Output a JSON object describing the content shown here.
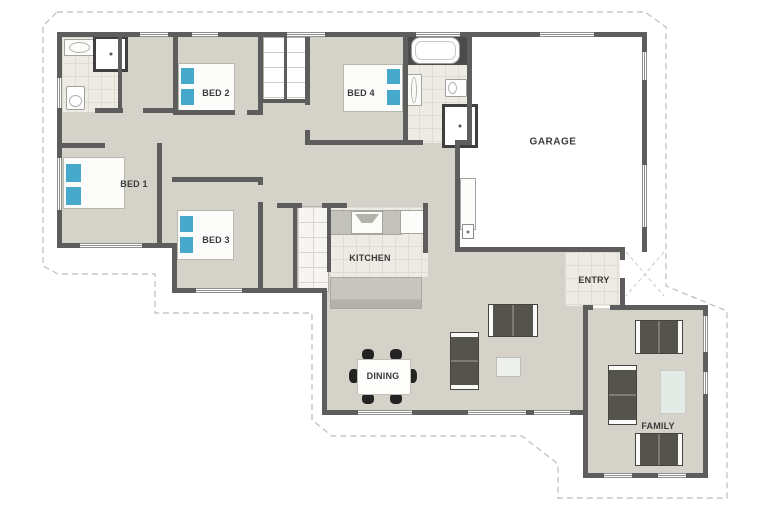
{
  "plan": {
    "rooms": {
      "garage": "GARAGE",
      "bed1": "BED 1",
      "bed2": "BED 2",
      "bed3": "BED 3",
      "bed4": "BED 4",
      "kitchen": "KITCHEN",
      "dining": "DINING",
      "entry": "ENTRY",
      "family": "FAMILY"
    },
    "colors": {
      "wall": "#5d5d5d",
      "floor": "#d5d2c9",
      "tile": "#edebe4",
      "pillow_blue": "#46a8cb",
      "sofa_dark": "#55544c",
      "counter_gray": "#c2c1ba",
      "boundary_dash": "#bcbcbc",
      "label_text": "#3b3b3b"
    }
  }
}
